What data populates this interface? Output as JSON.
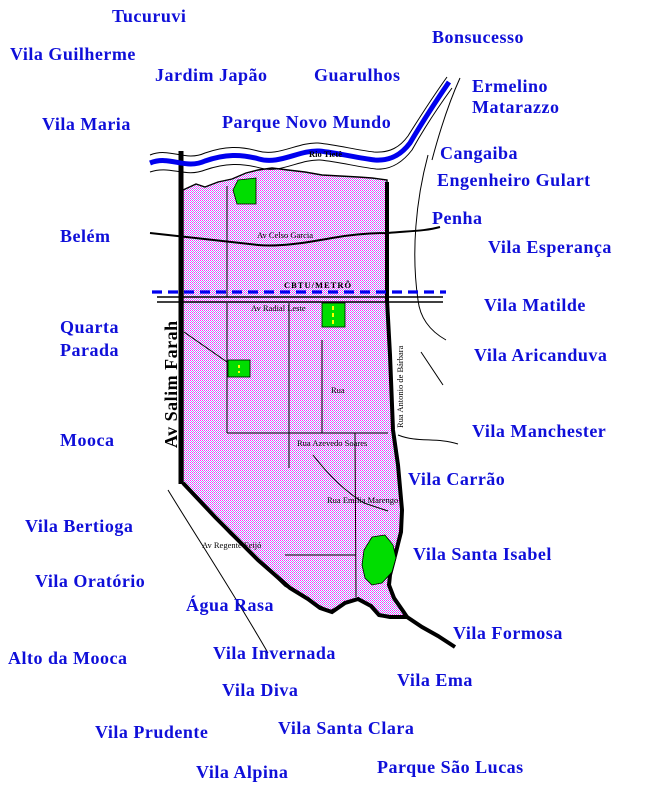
{
  "map_type": "district-street-map",
  "district": "Tatuapé area (São Paulo)",
  "colors": {
    "label_blue": "#0f0fd9",
    "river_blue": "#0000ee",
    "metro_dash_blue": "#0000f0",
    "park_green": "#00dd00",
    "district_dot_magenta": "#ff2bff",
    "district_dot_periwinkle": "#9d9df2",
    "road_black": "#000000",
    "park_road_yellow": "#ffff00"
  },
  "neighborhoods": {
    "tucuruvi": "Tucuruvi",
    "vila_guilherme": "Vila Guilherme",
    "jardim_japao": "Jardim Japão",
    "bonsucesso": "Bonsucesso",
    "guarulhos": "Guarulhos",
    "ermelino_matarazzo": {
      "line1": "Ermelino",
      "line2": "Matarazzo"
    },
    "vila_maria": "Vila Maria",
    "parque_novo_mundo": "Parque Novo Mundo",
    "cangaiba": "Cangaiba",
    "engenheiro_gulart": "Engenheiro Gulart",
    "penha": "Penha",
    "belem": "Belém",
    "vila_esperanca": "Vila Esperança",
    "vila_matilde": "Vila Matilde",
    "quarta_parada": {
      "line1": "Quarta",
      "line2": "Parada"
    },
    "vila_aricanduva": "Vila Aricanduva",
    "mooca": "Mooca",
    "vila_manchester": "Vila Manchester",
    "vila_carrao": "Vila Carrão",
    "vila_bertioga": "Vila Bertioga",
    "vila_santa_isabel": "Vila Santa Isabel",
    "vila_oratorio": "Vila Oratório",
    "agua_rasa": "Água Rasa",
    "vila_formosa": "Vila Formosa",
    "alto_da_mooca": "Alto da Mooca",
    "vila_invernada": "Vila Invernada",
    "vila_ema": "Vila Ema",
    "vila_diva": "Vila Diva",
    "vila_prudente": "Vila Prudente",
    "vila_santa_clara": "Vila Santa Clara",
    "vila_alpina": "Vila Alpina",
    "parque_sao_lucas": "Parque São Lucas"
  },
  "streets": {
    "rio_tiete": "Rio Tietê",
    "av_celso_garcia": "Av Celso Garcia",
    "cbtu_metro": "CBTU/METRÔ",
    "av_radial_leste": "Av Radial Leste",
    "rua": "Rua",
    "rua_azevedo_soares": "Rua Azevedo Soares",
    "rua_emilia_marengo": "Rua Emilia Marengo",
    "av_regente_feijo": "Av Regente Feijó",
    "rua_antonio_de_barbara": "Rua Antonio de Bárbara",
    "av_salim_farah": "Av Salim Farah"
  }
}
